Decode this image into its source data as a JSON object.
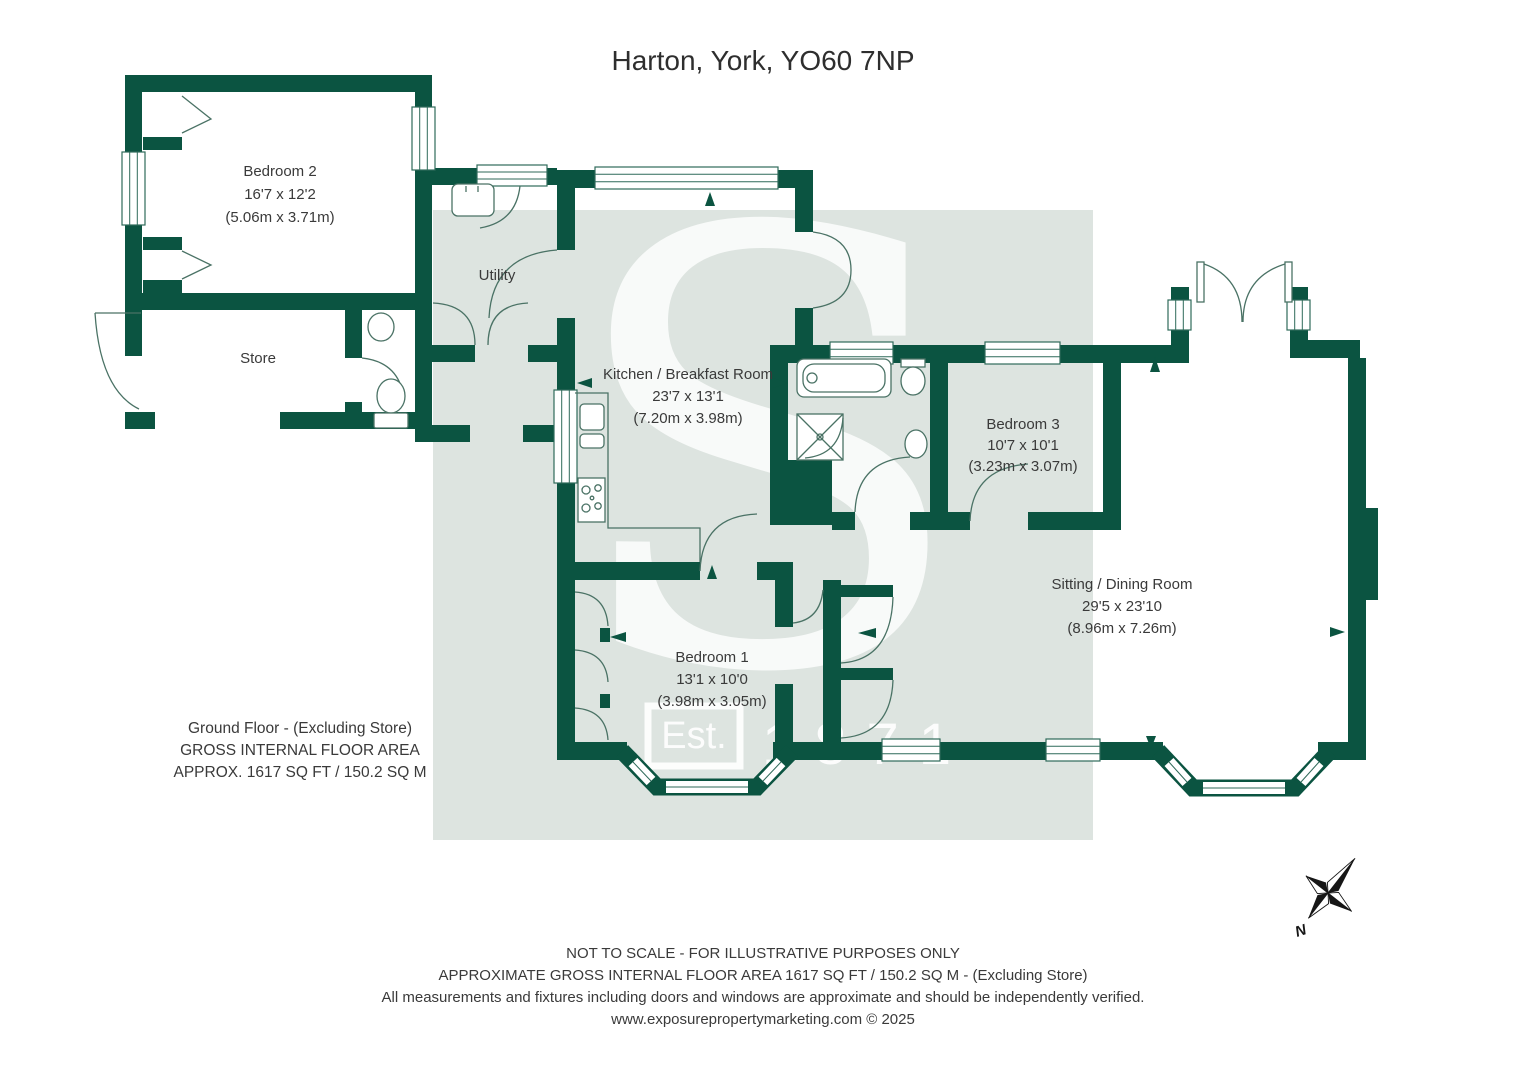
{
  "title": "Harton, York, YO60 7NP",
  "rooms": [
    {
      "name": "Bedroom 2",
      "imperial": "16'7 x 12'2",
      "metric": "(5.06m x 3.71m)"
    },
    {
      "name": "Store",
      "imperial": "",
      "metric": ""
    },
    {
      "name": "Utility",
      "imperial": "",
      "metric": ""
    },
    {
      "name": "Kitchen / Breakfast Room",
      "imperial": "23'7 x 13'1",
      "metric": "(7.20m x 3.98m)"
    },
    {
      "name": "Bedroom 3",
      "imperial": "10'7 x 10'1",
      "metric": "(3.23m x 3.07m)"
    },
    {
      "name": "Bedroom 1",
      "imperial": "13'1 x 10'0",
      "metric": "(3.98m x 3.05m)"
    },
    {
      "name": "Sitting / Dining Room",
      "imperial": "29'5 x 23'10",
      "metric": "(8.96m x 7.26m)"
    }
  ],
  "floor_summary": {
    "line1": "Ground Floor - (Excluding Store)",
    "line2": "GROSS INTERNAL FLOOR AREA",
    "line3": "APPROX. 1617 SQ FT / 150.2 SQ M"
  },
  "watermark": {
    "letter": "S",
    "est": "Est.",
    "year": "1871"
  },
  "compass": {
    "north_label": "N"
  },
  "footer": {
    "line1": "NOT TO SCALE - FOR ILLUSTRATIVE PURPOSES ONLY",
    "line2": "APPROXIMATE GROSS INTERNAL FLOOR AREA 1617 SQ FT / 150.2 SQ M - (Excluding Store)",
    "line3": "All measurements and fixtures including doors and windows are approximate and should be independently verified.",
    "line4": "www.exposurepropertymarketing.com © 2025"
  },
  "colors": {
    "wall_green": "#0b5441",
    "watermark_background": "#dde4e0",
    "detail_line": "#4a7265",
    "text": "#3a3a3a",
    "compass": "#161616"
  }
}
